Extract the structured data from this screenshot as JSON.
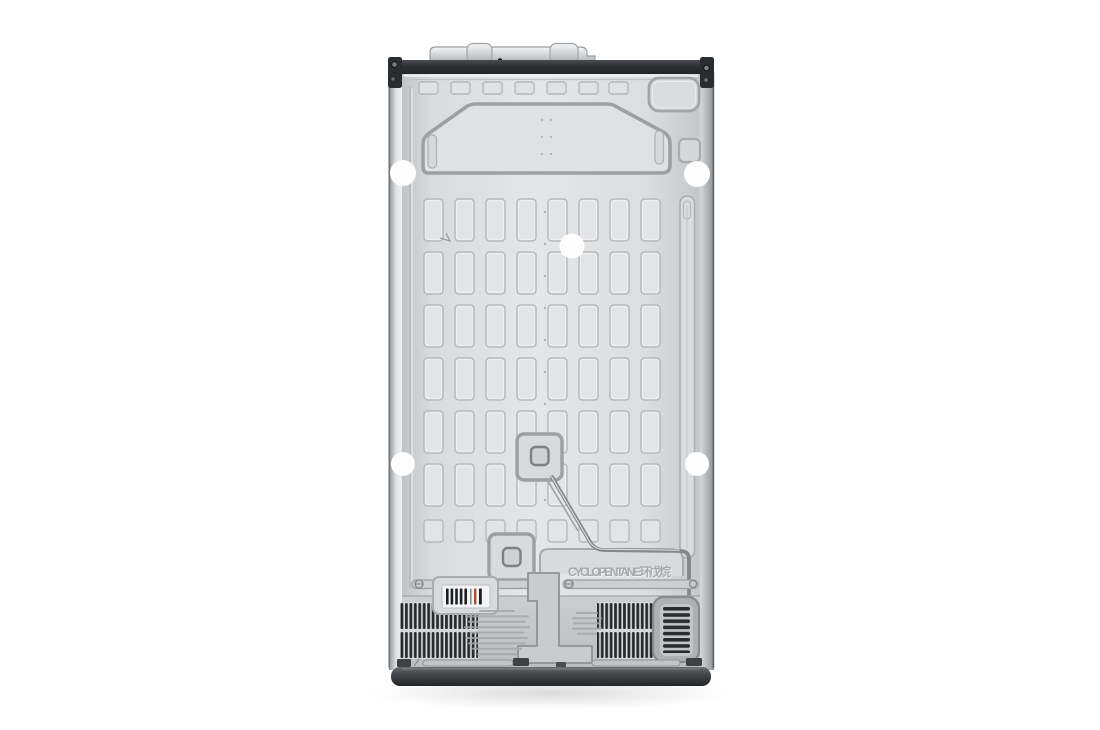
{
  "scene": {
    "type": "product-photo",
    "subject": "rear view of a refrigerator back panel on a white background",
    "background_color": "#ffffff"
  },
  "product": {
    "embossed_text": "CYCLOPENTANE 环戊烷",
    "colors": {
      "panel": "#dcdee0",
      "panel_emboss_line": "#a8abae",
      "top_band": "#2e3133",
      "base_bar": "#3b3e41",
      "vent_slat": "#26282a",
      "label_background": "#f3f4f5",
      "label_bar": "#1c1e20",
      "label_bar_accent": "#a8512f",
      "mounting_hole": "#ffffff"
    }
  }
}
